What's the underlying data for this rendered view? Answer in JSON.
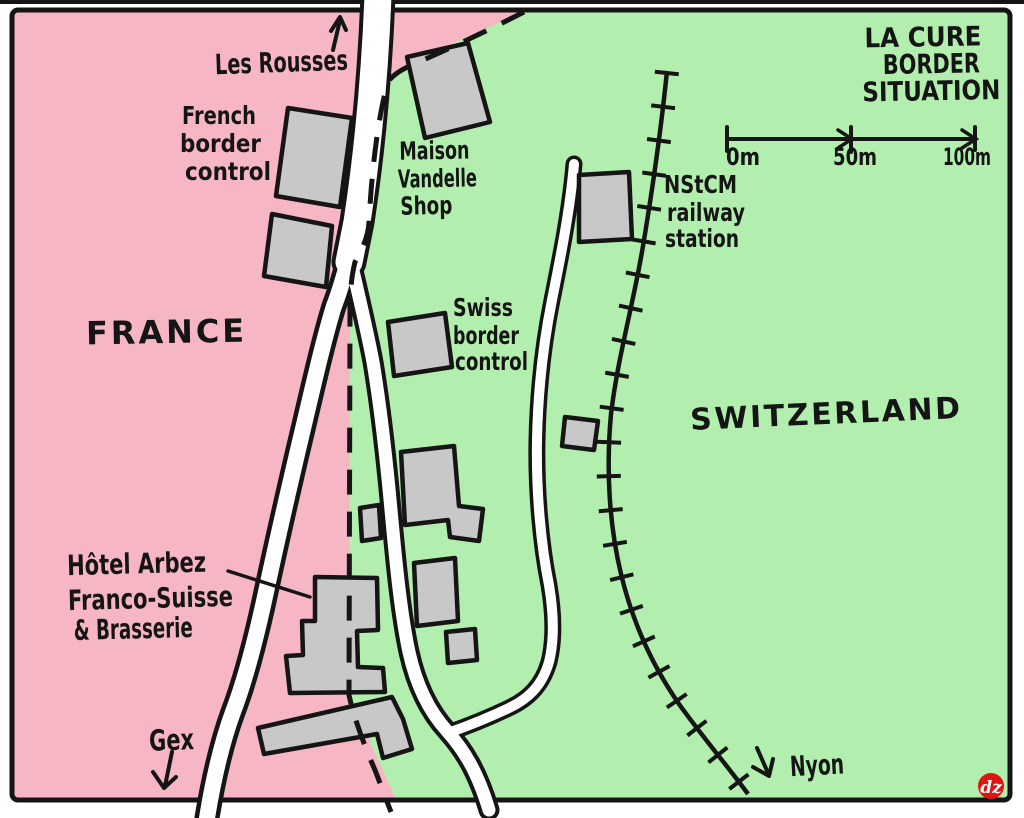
{
  "title": {
    "line1": "LA CURE",
    "line2": "BORDER",
    "line3": "SITUATION"
  },
  "regions": {
    "france": "FRANCE",
    "switzerland": "SWITZERLAND"
  },
  "places": {
    "les_rousses": "Les Rousses",
    "gex": "Gex",
    "nyon": "Nyon"
  },
  "labels": {
    "french_border": {
      "line1": "French",
      "line2": "border",
      "line3": "control"
    },
    "maison_vandelle": {
      "line1": "Maison",
      "line2": "Vandelle",
      "line3": "Shop"
    },
    "nstcm": {
      "line1": "NStCM",
      "line2": "railway",
      "line3": "station"
    },
    "swiss_border": {
      "line1": "Swiss",
      "line2": "border",
      "line3": "control"
    },
    "hotel_arbez": {
      "line1": "Hôtel Arbez",
      "line2": "Franco-Suisse",
      "line3": "& Brasserie"
    }
  },
  "scale_bar": {
    "tick0": "0m",
    "tick50": "50m",
    "tick100": "100m"
  },
  "logo": {
    "text": "dz"
  },
  "colors": {
    "france_pink": "#f6b6c4",
    "switzerland_green": "#b2efae",
    "building_gray": "#c8c8c8",
    "ink": "#151515",
    "paper": "#ffffff",
    "logo_red": "#e01410"
  }
}
